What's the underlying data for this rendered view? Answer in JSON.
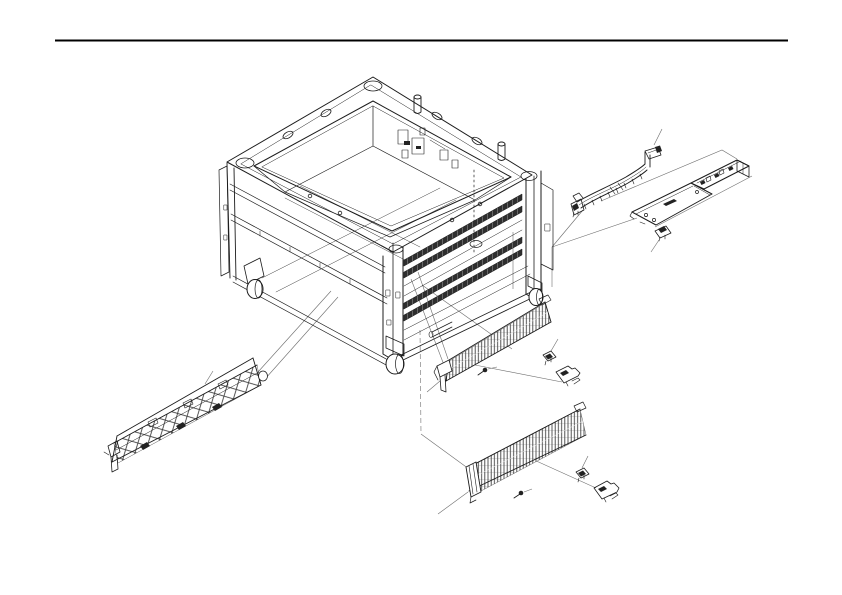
{
  "page": {
    "background": "#ffffff"
  },
  "divider": {
    "color": "#000000"
  },
  "colors": {
    "ink": "#1c1c1c",
    "thin_line": "#6e6e6e",
    "dark_fill": "#222222",
    "background": "#ffffff"
  },
  "diagram": {
    "type": "exploded-parts-line-drawing",
    "parts": [
      {
        "name": "chassis-frame"
      },
      {
        "name": "caster-wheel-left"
      },
      {
        "name": "caster-wheel-front"
      },
      {
        "name": "caster-wheel-right"
      },
      {
        "name": "flat-flex-cable"
      },
      {
        "name": "top-mounting-bracket"
      },
      {
        "name": "cable-retaining-clip"
      },
      {
        "name": "front-rail-assembly"
      },
      {
        "name": "crossmember-rail-upper"
      },
      {
        "name": "crossmember-rail-lower"
      },
      {
        "name": "rail-screw-upper"
      },
      {
        "name": "rail-screw-lower"
      },
      {
        "name": "rail-clip-upper"
      },
      {
        "name": "rail-clip-lower"
      },
      {
        "name": "corner-bracket-upper"
      },
      {
        "name": "corner-bracket-lower"
      }
    ]
  }
}
